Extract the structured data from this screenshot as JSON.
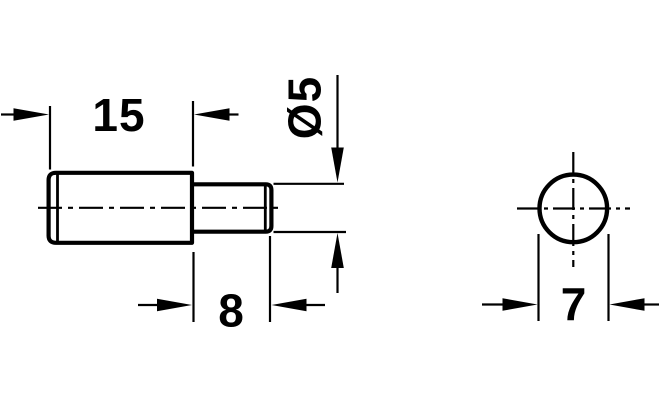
{
  "colors": {
    "ink": "#000000",
    "paper": "#ffffff"
  },
  "drawing": {
    "type": "technical-dimension-drawing",
    "side_view": {
      "body_length_label": "15",
      "pin_length_label": "8",
      "pin_diameter_label": "Ø5"
    },
    "end_view": {
      "diameter_label": "7"
    }
  }
}
